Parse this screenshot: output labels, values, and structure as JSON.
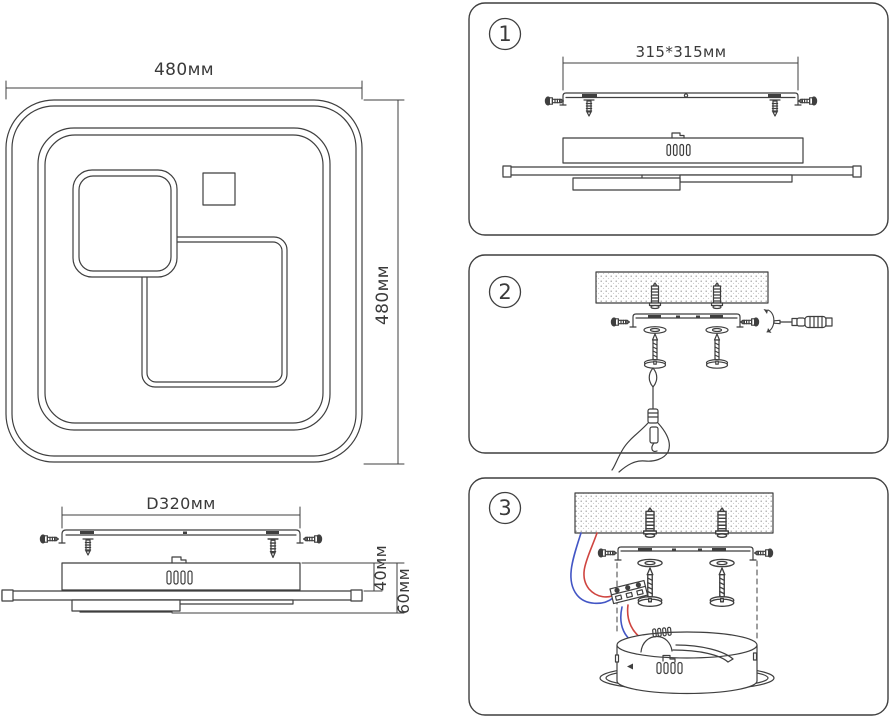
{
  "top_view": {
    "width_label": "480мм",
    "height_label": "480мм"
  },
  "side_view": {
    "width_label": "D320мм",
    "height_40_label": "40мм",
    "height_60_label": "60мм"
  },
  "panels": [
    {
      "number": "1",
      "dimension_label": "315*315мм"
    },
    {
      "number": "2"
    },
    {
      "number": "3"
    }
  ],
  "colors": {
    "line": "#3f3f3f",
    "wire_red": "#cf4540",
    "wire_blue": "#4356c5",
    "ceiling_dot": "#9a9a9a",
    "background": "#ffffff"
  }
}
